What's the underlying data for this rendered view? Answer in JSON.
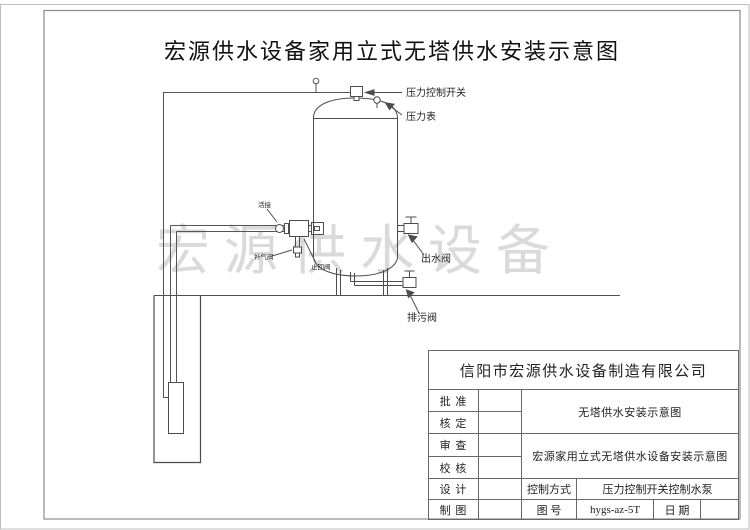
{
  "colors": {
    "line": "#4d4d4d",
    "frame": "#8c8c8c",
    "watermark": "#dadada",
    "text": "#1a1a1a"
  },
  "title": "宏源供水设备家用立式无塔供水安装示意图",
  "watermark": "宏源供水设备",
  "diagram": {
    "labels": {
      "pressure_switch": "压力控制开关",
      "pressure_gauge": "压力表",
      "union": "活接",
      "air_inlet_valve": "补气阀",
      "check_valve": "止回阀",
      "outlet_valve": "出水阀",
      "drain_valve": "排污阀"
    }
  },
  "title_block": {
    "company": "信阳市宏源供水设备制造有限公司",
    "row_labels": {
      "approve": "批 准",
      "ratify": "核 定",
      "review": "审 查",
      "proof": "校 核",
      "design": "设 计",
      "draft": "制 图"
    },
    "doc_title_small": "无塔供水安装示意图",
    "doc_title_full": "宏源家用立式无塔供水设备安装示意图",
    "control_mode_label": "控制方式",
    "control_mode_value": "压力控制开关控制水泵",
    "drawing_no_label": "图 号",
    "drawing_no_value": "hygs-az-5T",
    "date_label": "日 期"
  }
}
